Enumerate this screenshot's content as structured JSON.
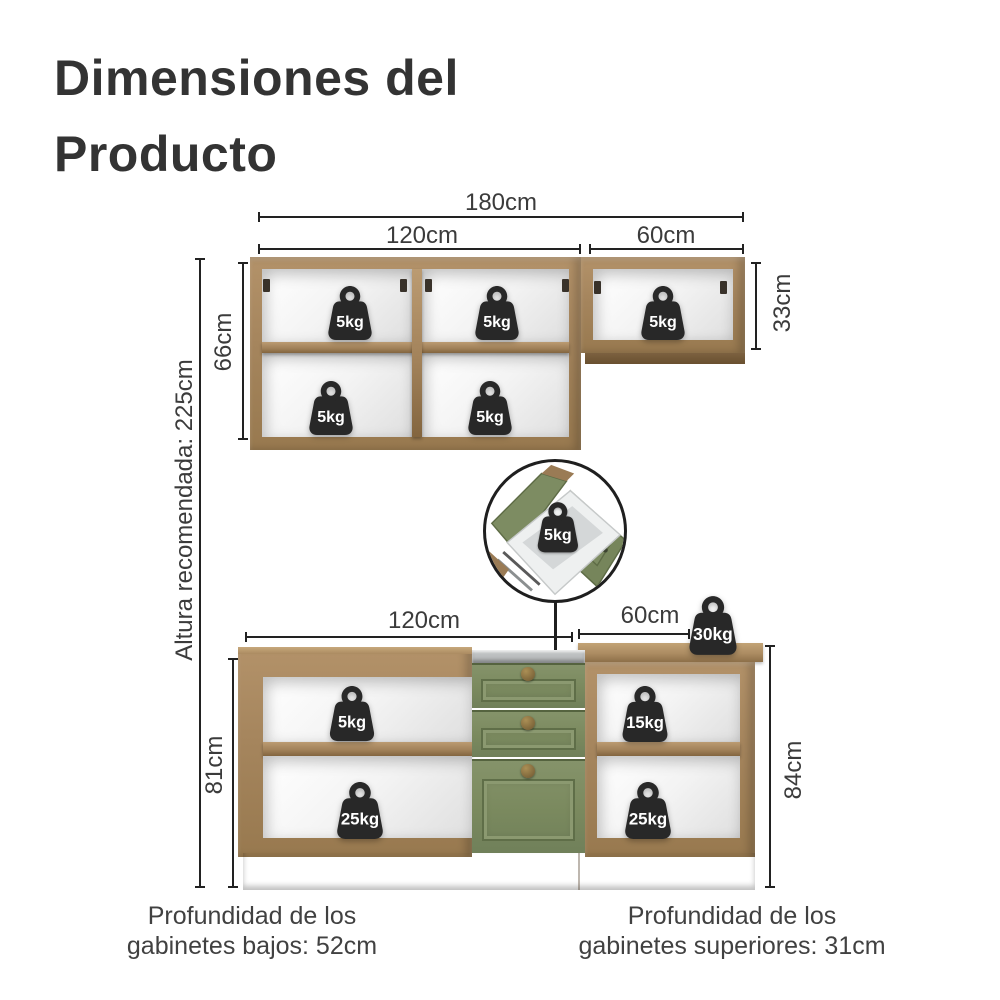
{
  "title": {
    "line1": "Dimensiones del",
    "line2": "Producto"
  },
  "upper_cabinet": {
    "width_total": "180cm",
    "width_left": "120cm",
    "width_right": "60cm",
    "height_left": "66cm",
    "height_right": "33cm",
    "weights": [
      "5kg",
      "5kg",
      "5kg",
      "5kg",
      "5kg"
    ]
  },
  "detail_drawer": {
    "weight": "5kg"
  },
  "lower_cabinet": {
    "width_left": "120cm",
    "width_right": "60cm",
    "height_left": "81cm",
    "height_right": "84cm",
    "countertop_weight": "30kg",
    "weights": {
      "left_top": "5kg",
      "left_bottom": "25kg",
      "right_top": "15kg",
      "right_bottom": "25kg"
    }
  },
  "recommended_height": "Altura recomendada: 225cm",
  "notes": {
    "left_line1": "Profundidad de los",
    "left_line2": "gabinetes bajos: 52cm",
    "right_line1": "Profundidad de los",
    "right_line2": "gabinetes superiores: 31cm"
  },
  "colors": {
    "wood": "#a5855d",
    "green": "#7a895e",
    "weight_icon": "#282828",
    "line": "#222222"
  }
}
